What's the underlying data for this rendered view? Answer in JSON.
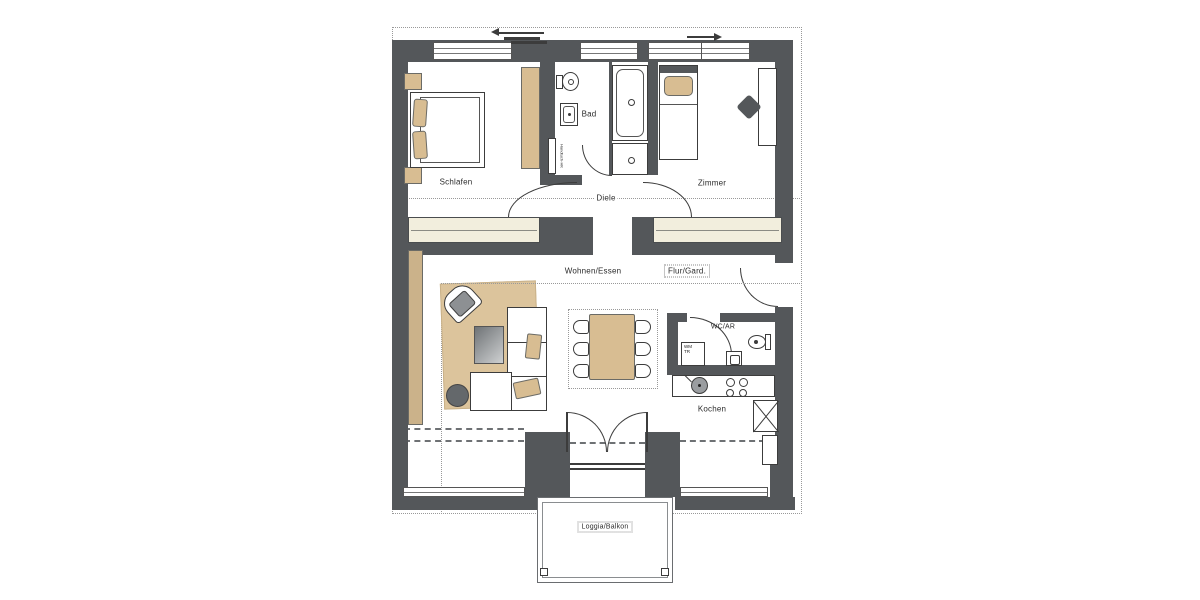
{
  "document_type": "apartment-floor-plan",
  "rooms": {
    "schlafen": {
      "label": "Schlafen",
      "furniture": [
        "double-bed",
        "pillow",
        "pillow",
        "nightstand",
        "nightstand",
        "wardrobe"
      ]
    },
    "bad": {
      "label": "Bad",
      "furniture": [
        "toilet",
        "sink",
        "bathtub",
        "shower",
        "towel-radiator"
      ]
    },
    "zimmer": {
      "label": "Zimmer",
      "furniture": [
        "single-bed",
        "pillow",
        "desk",
        "chair"
      ]
    },
    "diele": {
      "label": "Diele",
      "furniture": [
        "door-swing",
        "door-swing",
        "built-in-closet",
        "built-in-closet"
      ]
    },
    "wohnen_essen": {
      "label": "Wohnen/Essen",
      "furniture": [
        "rug",
        "armchair",
        "coffee-table",
        "corner-sofa",
        "cushion",
        "cushion",
        "side-table",
        "sideboard",
        "dining-table",
        "chair-x6"
      ]
    },
    "flur_gard": {
      "label": "Flur/Gard.",
      "furniture": [
        "entrance-door-swing"
      ]
    },
    "wc_ar": {
      "label": "WC/AR",
      "furniture": [
        "washer-dryer",
        "sink",
        "toilet",
        "door-swing"
      ]
    },
    "kochen": {
      "label": "Kochen",
      "furniture": [
        "counter",
        "sink",
        "hob-4-burners",
        "shaft-x-symbol"
      ]
    },
    "loggia": {
      "label": "Loggia/Balkon",
      "furniture": [
        "railing",
        "french-double-door"
      ]
    }
  },
  "annotations": {
    "handtuch_hk": "Handtuch-HK",
    "wm": {
      "line1": "WM",
      "line2": "TR"
    }
  },
  "symbols": {
    "arrow_left": "window-slide-direction-left",
    "arrow_right": "window-slide-direction-right",
    "x_box": "shaft",
    "dotted_outline": "section-boundary"
  },
  "colors": {
    "wall": "#54575a",
    "floor": "#ffffff",
    "closet_cream": "#f2eedd",
    "furniture_tan": "#d8bd92",
    "rug_tan": "#dcc49c",
    "gray_furniture": "#64686b",
    "outline": "#3c3c3c",
    "dotted": "#999999"
  }
}
